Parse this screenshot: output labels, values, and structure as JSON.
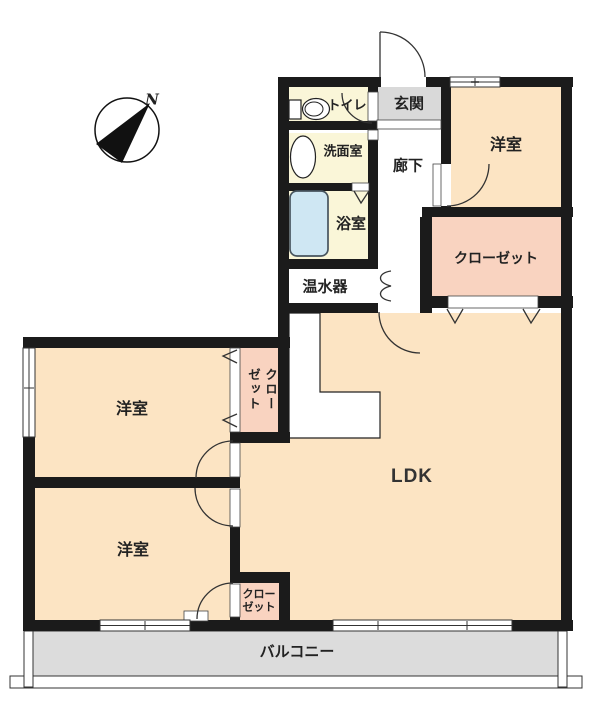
{
  "compass": {
    "north_label": "N"
  },
  "rooms": {
    "toilet": {
      "label": "トイレ"
    },
    "entrance": {
      "label": "玄関"
    },
    "washroom": {
      "label": "洗面室"
    },
    "hallway": {
      "label": "廊下"
    },
    "bathroom": {
      "label": "浴室"
    },
    "water_heater": {
      "label": "温水器"
    },
    "bedroom_ne": {
      "label": "洋室"
    },
    "closet_right": {
      "label": "クローゼット"
    },
    "closet_west": {
      "label": "クローゼット"
    },
    "bedroom_west": {
      "label": "洋室"
    },
    "bedroom_sw": {
      "label": "洋室"
    },
    "closet_sw": {
      "label": "クロー\nゼット"
    },
    "ldk": {
      "label": "LDK"
    },
    "balcony": {
      "label": "バルコニー"
    }
  },
  "colors": {
    "wall": "#1b1b1b",
    "line": "#333333",
    "room_cream": "#faf6d8",
    "room_peach": "#fce4c3",
    "closet_pink": "#f9d3c0",
    "entrance_gray": "#d9d9d9",
    "balcony_gray": "#dcdcdc",
    "bathtub_blue": "#cfe7f3"
  }
}
